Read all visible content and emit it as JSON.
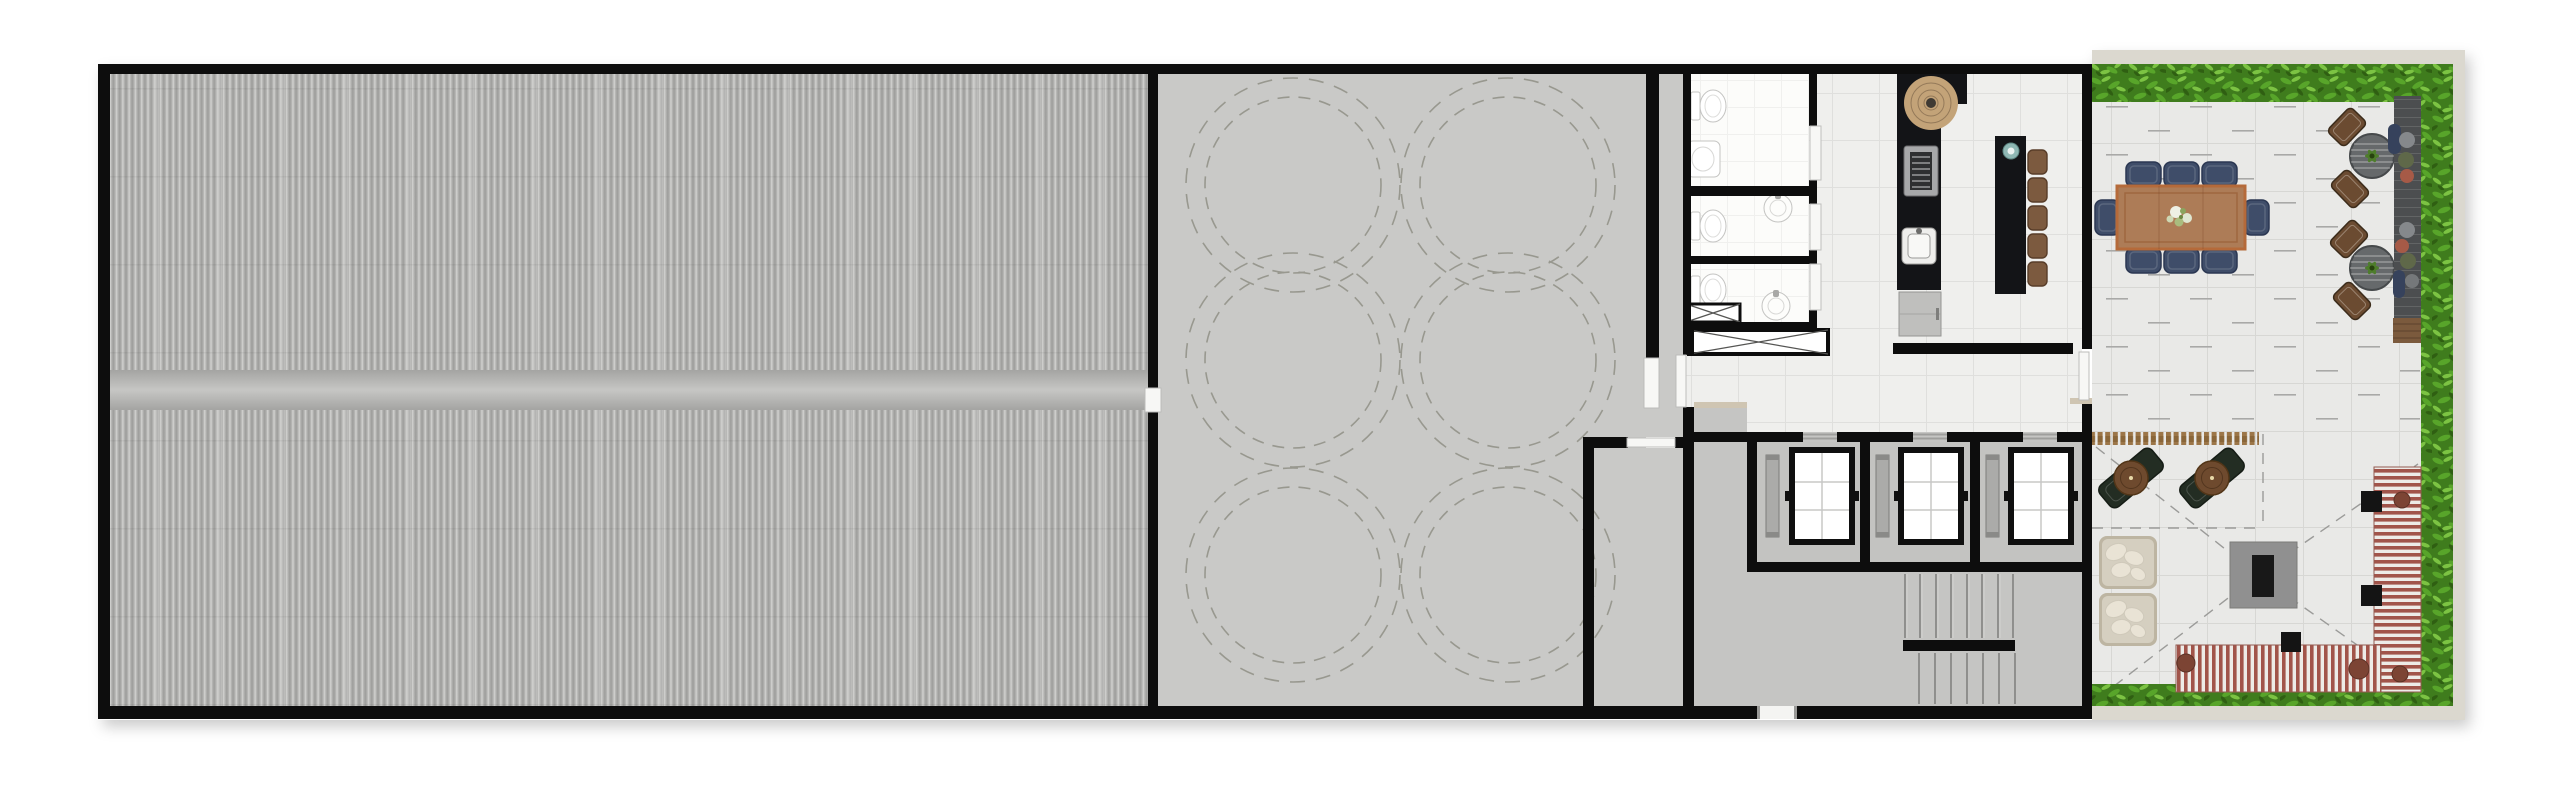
{
  "document": {
    "type": "architectural-floor-plan",
    "label": "Top-down rooftop floor plan with corrugated roof, tank slab, core services and furnished terrace",
    "visible_text": []
  },
  "zones": [
    {
      "id": "metal-roof",
      "label": "Corrugated metal roof area with central walkway band"
    },
    {
      "id": "slab-area",
      "label": "Concrete slab room with dashed tank circles",
      "circle_pairs": 6
    },
    {
      "id": "service-room",
      "label": "Small service room lower right of slab area",
      "doors": 1
    },
    {
      "id": "restrooms",
      "label": "Toilet stall block",
      "stalls": 3,
      "toilets": 3,
      "sinks": 3
    },
    {
      "id": "duct-shafts",
      "label": "Ventilation shafts marked with X",
      "count": 2
    },
    {
      "id": "kitchen-bar",
      "label": "Bar kitchen with counter, grill, sink, island",
      "bar_stools": 5
    },
    {
      "id": "elevator-bank",
      "label": "Elevator shafts with cabs and counterweight rails",
      "elevators": 3
    },
    {
      "id": "staircase",
      "label": "Two-flight scissor stair with landing",
      "flights": 2
    },
    {
      "id": "terrace-dining",
      "label": "Terrace dining area",
      "dining_chairs": 8,
      "bistro_tables": 2,
      "bistro_chairs": 4,
      "deck_poufs": 8
    },
    {
      "id": "terrace-lounge",
      "label": "Terrace lounge",
      "chaises": 2,
      "chaise_tables": 2,
      "daybeds": 2,
      "fire_pits": 1,
      "striped_sofas": 2,
      "side_tables": 3
    },
    {
      "id": "hedges",
      "label": "Perimeter hedge planting on terrace",
      "sides": 3
    }
  ],
  "colors": {
    "wall": "#0d0d0d",
    "rib_dark": "#9c9c9a",
    "rib_mid": "#b7b7b5",
    "rib_light": "#d3d3d1",
    "band": "#c6c6c4",
    "slab": "#c9c9c7",
    "dashline": "#98988f",
    "lobby": "#c5c5c3",
    "tile": "#efefed",
    "tile_line": "#dfdfdd",
    "bath": "#fcfcfa",
    "bath_line": "#f0f0ee",
    "terrace_tile": "#e9e9e7",
    "terrace_line": "#d7d7d4",
    "dash": "#a9a9a7",
    "beige": "#dbd8cf",
    "threshold": "#cfc5b2",
    "door": "#f7f7f5",
    "hedge_base": "#3f7c1d",
    "hedge_mid": "#58a52a",
    "hedge_light": "#7cc343",
    "hedge_dark": "#2c5a10",
    "wood": "#ad7c57",
    "wood_trim": "#b56a3a",
    "navy": "#3f4d69",
    "navy_dark": "#2b3752",
    "bistro_table": "#66696b",
    "bistro_chair": "#6b4b31",
    "deck": "#4c4e50",
    "deck_wood": "#7b5a3d",
    "counter": "#131417",
    "stool": "#7c5a3f",
    "rattan": "#c3a378",
    "vase": "#8fb8b4",
    "cabinet": "#bfbfbd",
    "rail": "#ababa9",
    "stair_line": "#828280",
    "chaise": "#232d23",
    "chaise_table": "#6e4a2e",
    "daybed": "#d5cfc0",
    "daybed_edge": "#bdb5a2",
    "pillow": "#e9e3d5",
    "firepit": "#909090",
    "firepit_core": "#181818",
    "stripe_red": "#a1544a",
    "stripe_white": "#edebe7",
    "side_table": "#141414",
    "pouf_navy": "#36425c",
    "pouf_gray": "#85888b",
    "pouf_olive": "#5f6849",
    "pouf_rust": "#a65a47",
    "fixture_line": "#c4c4c2"
  }
}
